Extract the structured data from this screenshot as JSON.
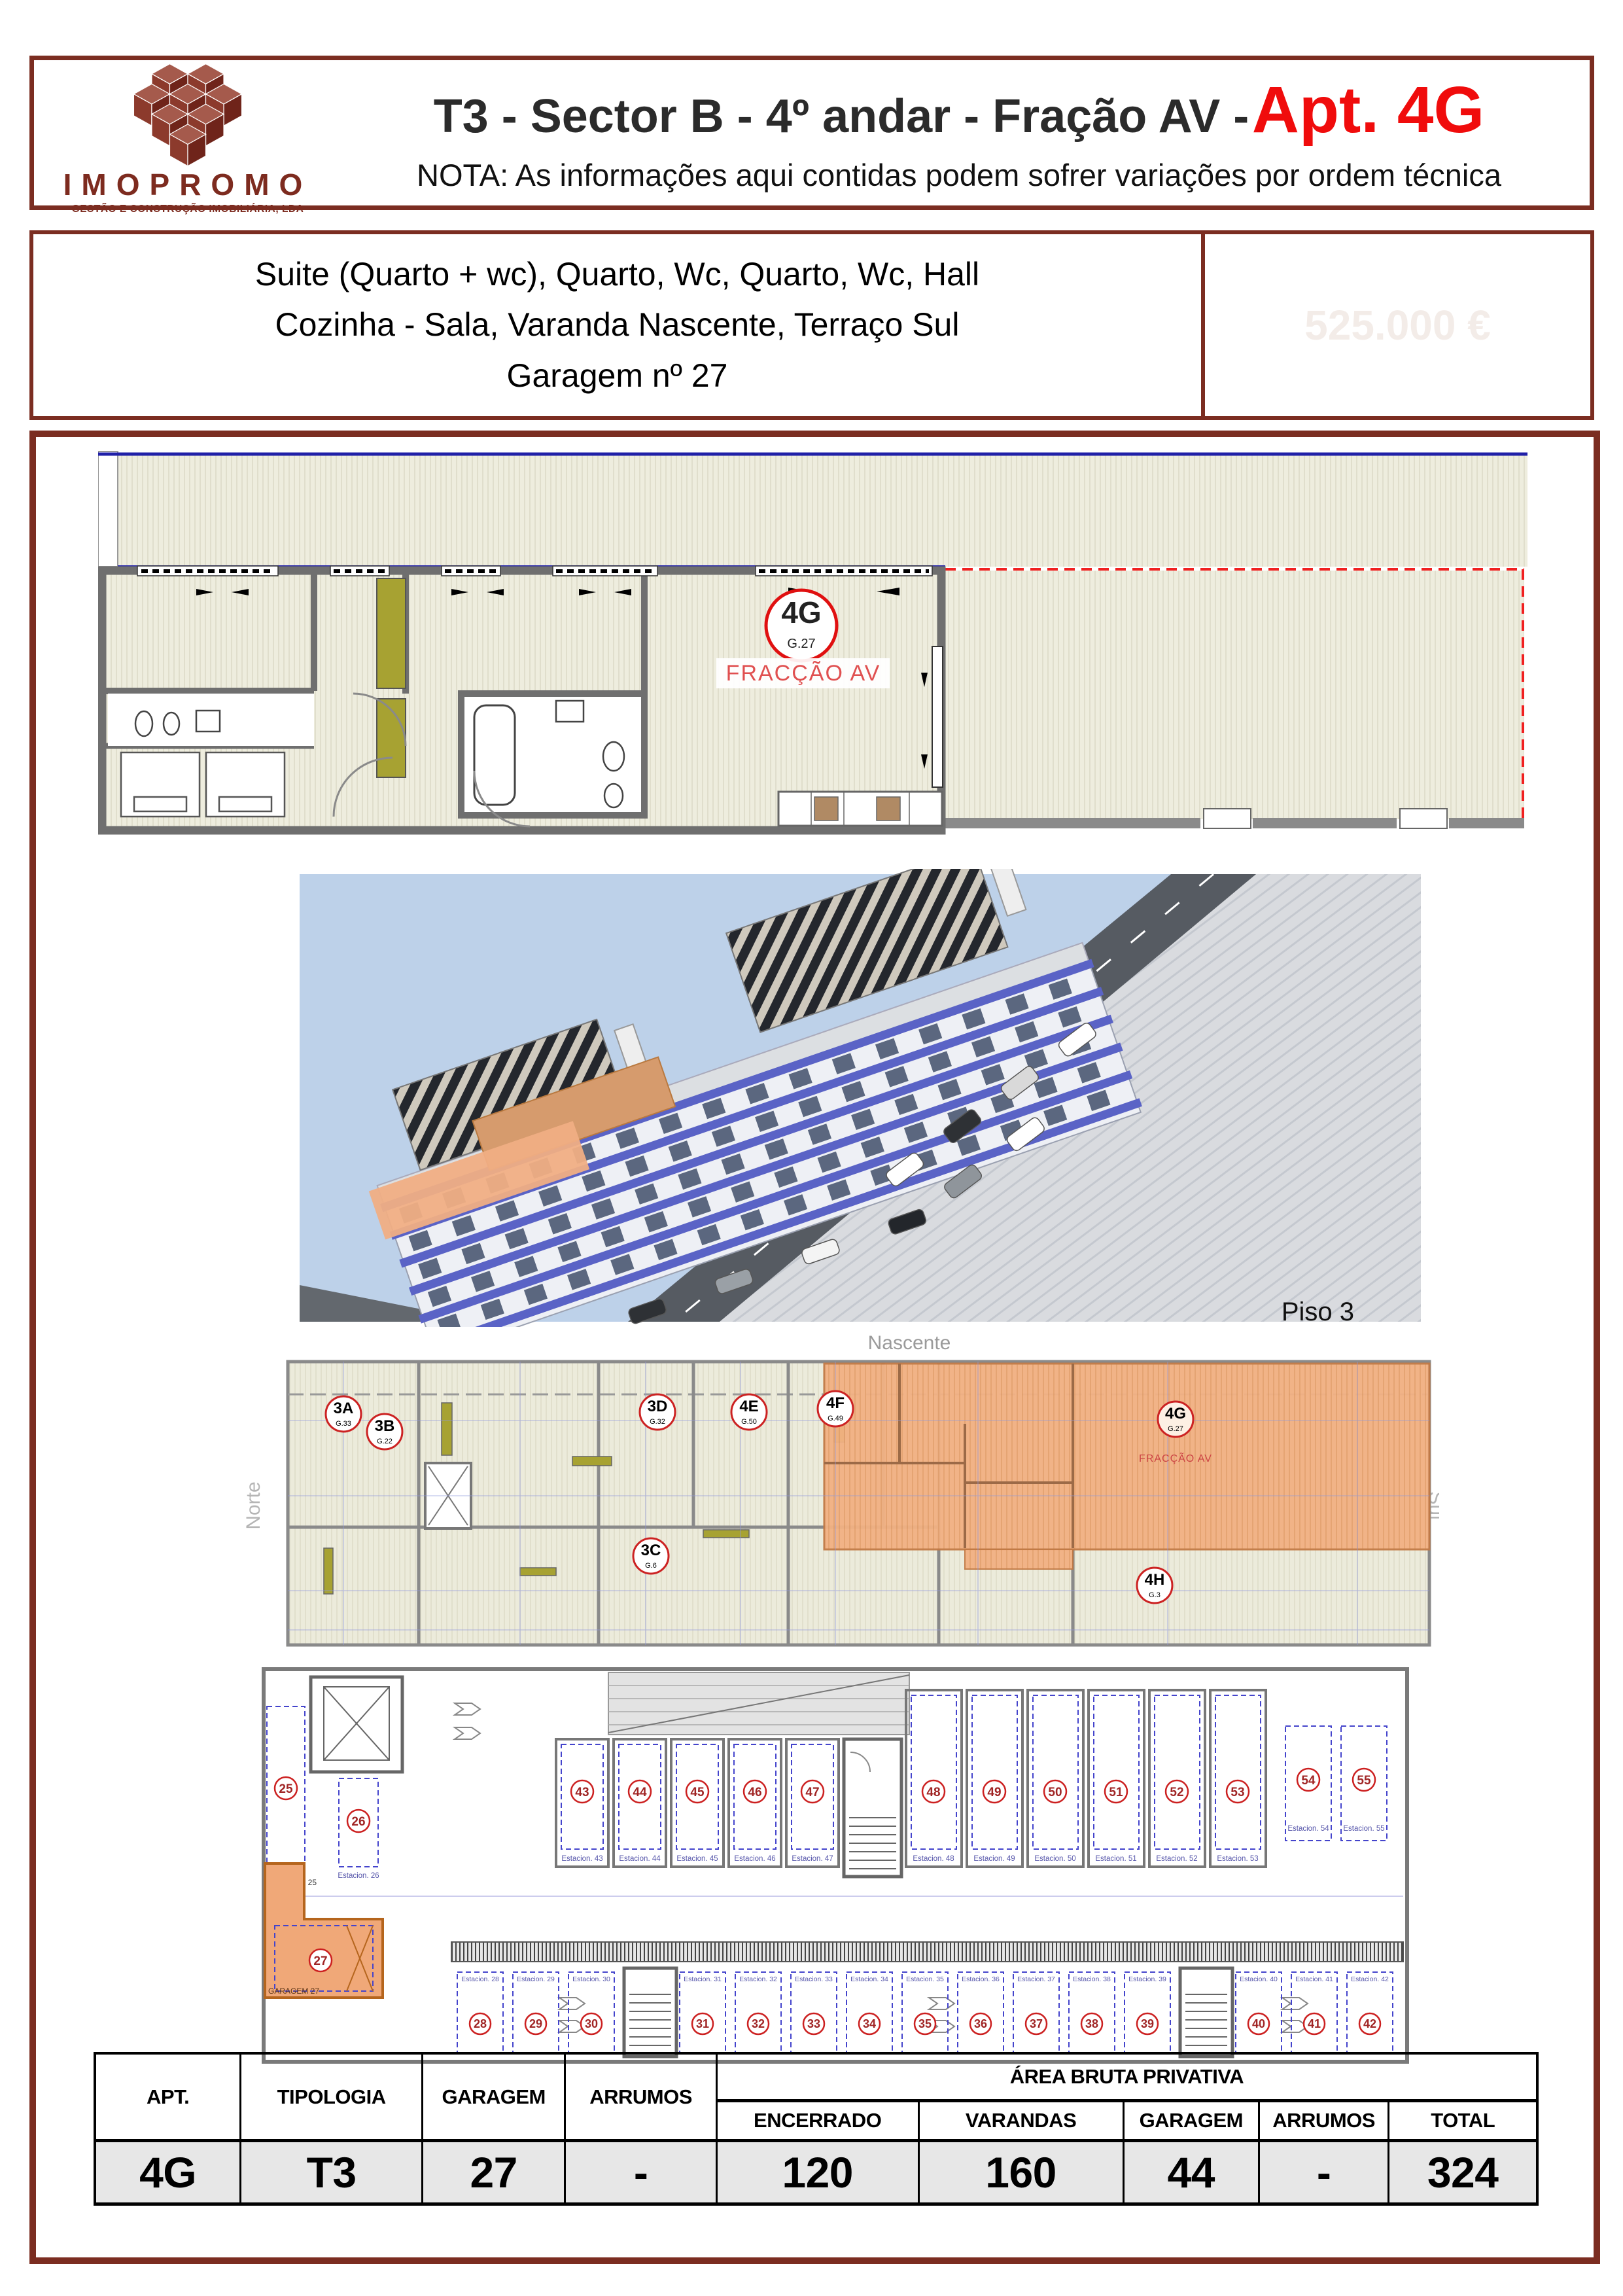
{
  "colors": {
    "maroon_border": "#7b2d21",
    "title_red": "#f00c0c",
    "logo_red": "#7d2b1f",
    "plan_cream": "#eeedde",
    "plan_olive": "#a7a232",
    "plan_wall_gray": "#6f6f6f",
    "blue_line": "#2020a8",
    "red_dashed": "#f02020",
    "orange_highlight": "#f0a878",
    "sky_blue": "#bdd1e9",
    "facade_band_blue": "#5a63c6",
    "table_row_bg": "#e7e7e7"
  },
  "header": {
    "logo_name": "IMOPROMO",
    "logo_tagline": "GESTÃO E CONSTRUÇÃO IMOBILIÁRIA, LDA",
    "title_black": "T3 - Sector B - 4º andar - Fração AV -",
    "title_red": "Apt. 4G",
    "note": "NOTA: As informações aqui contidas podem sofrer variações por ordem técnica"
  },
  "description": {
    "line1": "Suite (Quarto + wc), Quarto, Wc, Quarto, Wc, Hall",
    "line2": "Cozinha - Sala, Varanda Nascente, Terraço Sul",
    "line3": "Garagem nº 27",
    "price_watermark": "525.000 €"
  },
  "floor_plan": {
    "unit": "4G",
    "unit_sub": "G.27",
    "fraction": "FRACÇÃO AV"
  },
  "render": {
    "caption": "Piso 3"
  },
  "piso3": {
    "orientation_top": "Nascente",
    "orientation_left": "Norte",
    "orientation_right": "Sul",
    "fraction": "FRACÇÃO AV",
    "units": [
      {
        "id": "3A",
        "sub": "G.33"
      },
      {
        "id": "3B",
        "sub": "G.22"
      },
      {
        "id": "3D",
        "sub": "G.32"
      },
      {
        "id": "4E",
        "sub": "G.50"
      },
      {
        "id": "4F",
        "sub": "G.49"
      },
      {
        "id": "4G",
        "sub": "G.27"
      },
      {
        "id": "3C",
        "sub": "G.6"
      },
      {
        "id": "4H",
        "sub": "G.3"
      }
    ]
  },
  "garage": {
    "left": [
      {
        "n": "25",
        "e": "GARAGEM 25"
      },
      {
        "n": "26",
        "e": "Estacion. 26"
      },
      {
        "n": "27",
        "e": "GARAGEM 27"
      }
    ],
    "top": [
      {
        "n": "43",
        "e": "Estacion. 43"
      },
      {
        "n": "44",
        "e": "Estacion. 44"
      },
      {
        "n": "45",
        "e": "Estacion. 45"
      },
      {
        "n": "46",
        "e": "Estacion. 46"
      },
      {
        "n": "47",
        "e": "Estacion. 47"
      },
      {
        "n": "48",
        "e": "Estacion. 48"
      },
      {
        "n": "49",
        "e": "Estacion. 49"
      },
      {
        "n": "50",
        "e": "Estacion. 50"
      },
      {
        "n": "51",
        "e": "Estacion. 51"
      },
      {
        "n": "52",
        "e": "Estacion. 52"
      },
      {
        "n": "53",
        "e": "Estacion. 53"
      },
      {
        "n": "54",
        "e": "Estacion. 54"
      },
      {
        "n": "55",
        "e": "Estacion. 55"
      }
    ],
    "bottom": [
      {
        "n": "28",
        "e": "Estacion. 28"
      },
      {
        "n": "29",
        "e": "Estacion. 29"
      },
      {
        "n": "30",
        "e": "Estacion. 30"
      },
      {
        "n": "31",
        "e": "Estacion. 31"
      },
      {
        "n": "32",
        "e": "Estacion. 32"
      },
      {
        "n": "33",
        "e": "Estacion. 33"
      },
      {
        "n": "34",
        "e": "Estacion. 34"
      },
      {
        "n": "35",
        "e": "Estacion. 35"
      },
      {
        "n": "36",
        "e": "Estacion. 36"
      },
      {
        "n": "37",
        "e": "Estacion. 37"
      },
      {
        "n": "38",
        "e": "Estacion. 38"
      },
      {
        "n": "39",
        "e": "Estacion. 39"
      },
      {
        "n": "40",
        "e": "Estacion. 40"
      },
      {
        "n": "41",
        "e": "Estacion. 41"
      },
      {
        "n": "42",
        "e": "Estacion. 42"
      }
    ]
  },
  "table": {
    "headers": {
      "apt": "APT.",
      "tipologia": "TIPOLOGIA",
      "garagem": "GARAGEM",
      "arrumos": "ARRUMOS",
      "group": "ÁREA BRUTA PRIVATIVA",
      "encerrado": "ENCERRADO",
      "varandas": "VARANDAS",
      "garagem2": "GARAGEM",
      "arrumos2": "ARRUMOS",
      "total": "TOTAL"
    },
    "row": {
      "apt": "4G",
      "tipologia": "T3",
      "garagem": "27",
      "arrumos": "-",
      "encerrado": "120",
      "varandas": "160",
      "garagem2": "44",
      "arrumos2": "-",
      "total": "324"
    }
  }
}
